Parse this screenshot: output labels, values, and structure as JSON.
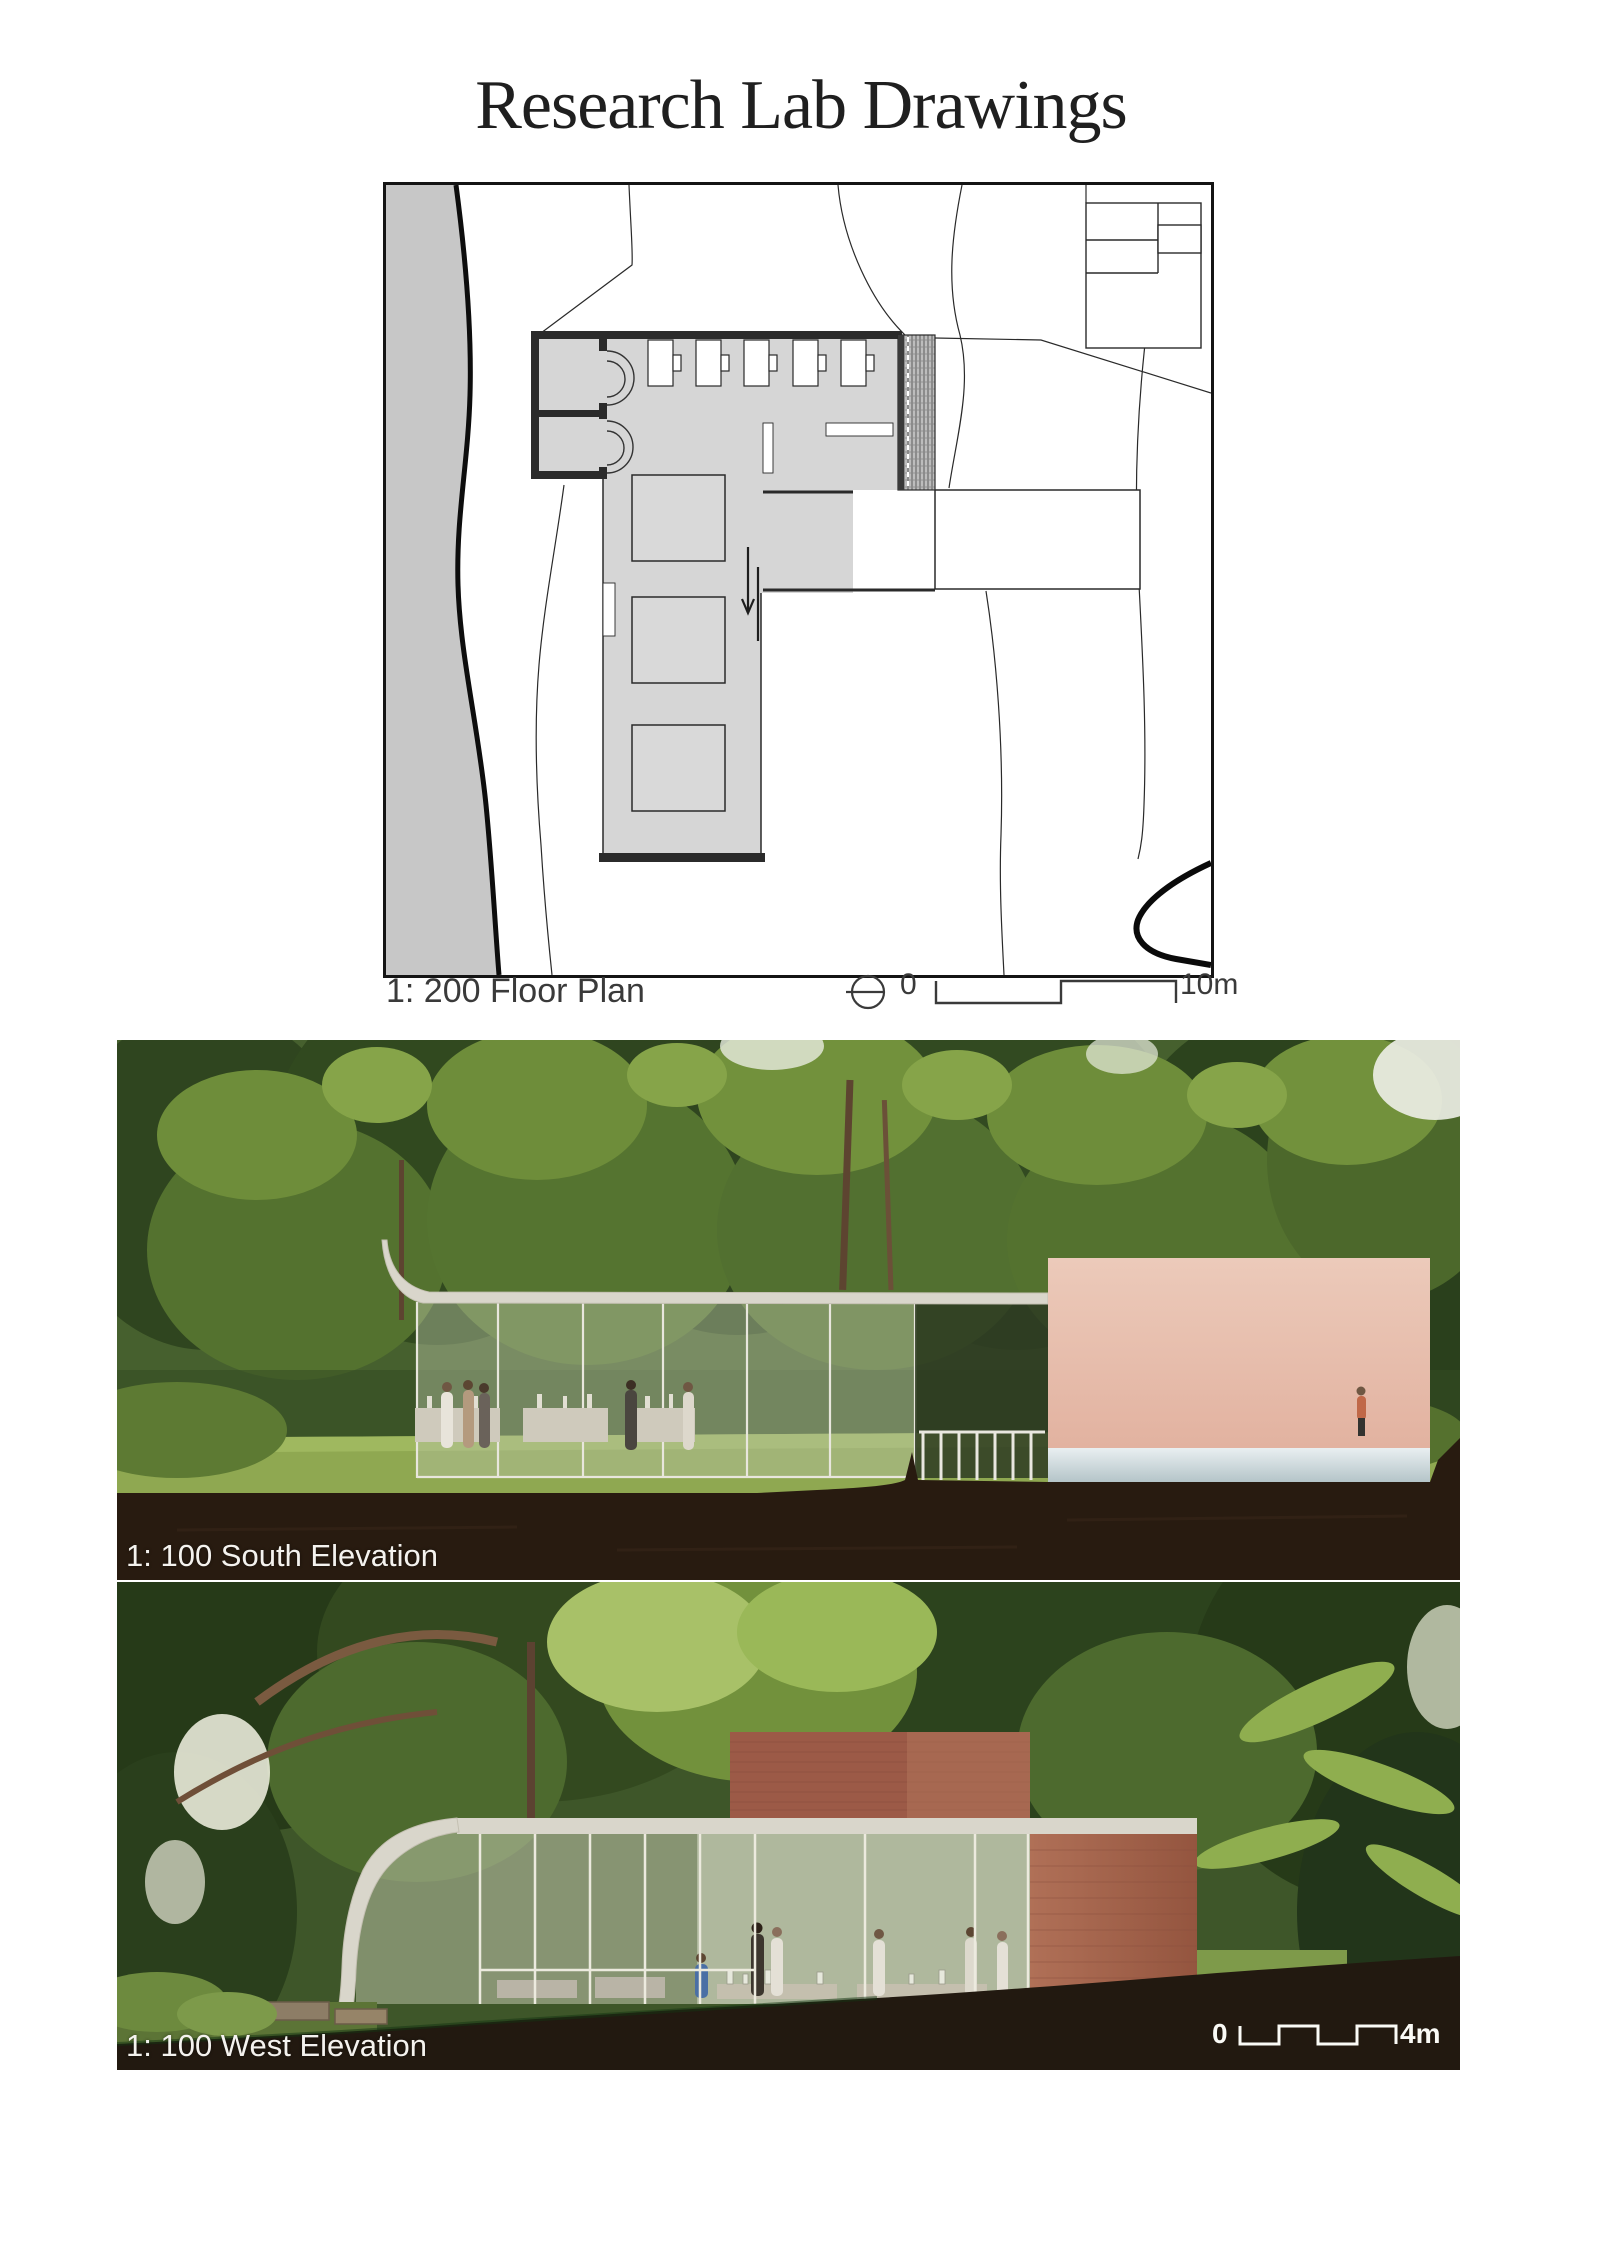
{
  "page": {
    "title": "Research Lab Drawings"
  },
  "floor_plan": {
    "caption": "1: 200 Floor Plan",
    "scale_start": "0",
    "scale_end": "10m"
  },
  "south_elevation": {
    "caption": "1: 100 South Elevation"
  },
  "west_elevation": {
    "caption": "1: 100 West Elevation",
    "scale_start": "0",
    "scale_end": "4m"
  },
  "colors": {
    "ink": "#1f1f1f",
    "plan_floor": "#d6d6d6",
    "plan_river": "#c7c7c7",
    "wall_dark": "#2b2b2b",
    "canopy_green": "#46602e",
    "lawn_green": "#8fa851",
    "soil_brown": "#281b10",
    "brick_pink": "#e9c3b1",
    "brick_red": "#9c5a47",
    "concrete": "#d9d6cb"
  }
}
